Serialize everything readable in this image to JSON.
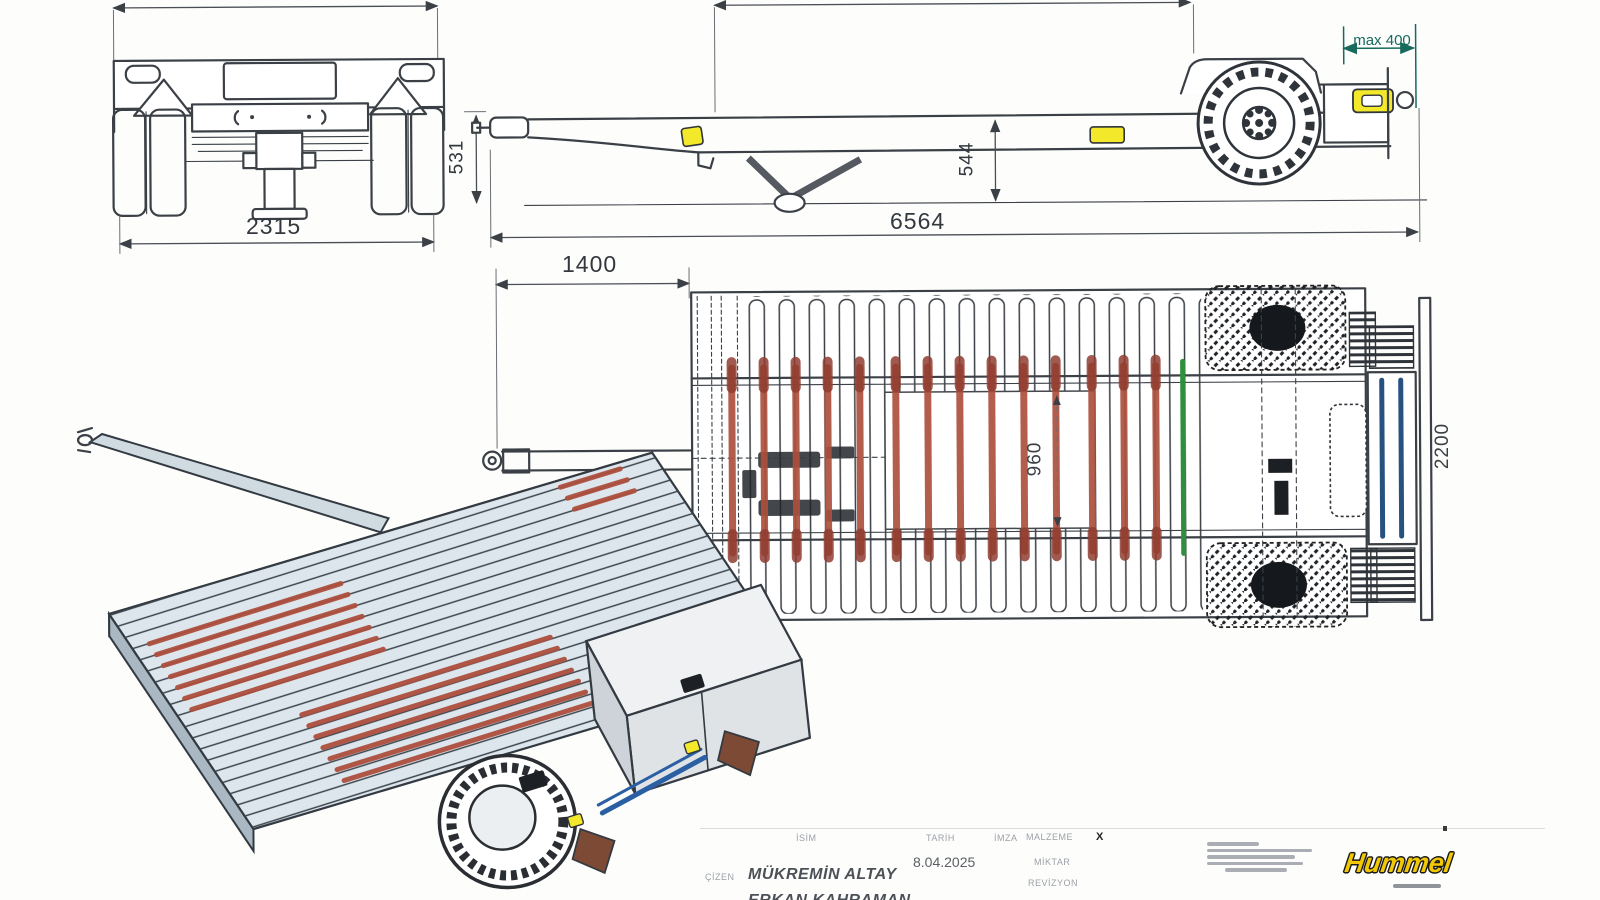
{
  "dimensions": {
    "rear_width": "2315",
    "hitch_height": "531",
    "platform_height": "544",
    "overall_length": "6564",
    "drawbar_length": "1400",
    "inner_width": "960",
    "platform_width": "2200",
    "rear_overhang": "max 400"
  },
  "title_block": {
    "cizen_label": "ÇİZEN",
    "isim_label": "İSİM",
    "tarih_label": "TARİH",
    "imza_label": "İMZA",
    "malzeme_label": "MALZEME",
    "miktar_label": "MİKTAR",
    "revizyon_label": "REVİZYON",
    "drawn_by": "MÜKREMİN ALTAY",
    "drawn_by_2": "ERKAN KAHRAMAN",
    "date": "8.04.2025",
    "malzeme_value": "X"
  },
  "branding": {
    "logo_text": "Hummel"
  },
  "colors": {
    "strap_red": "#ad4f3e",
    "strap_green": "#2e8f3c",
    "strap_blue": "#27527f",
    "dim_teal": "#176a5c",
    "marker_yellow": "#f3e92a",
    "logo_yellow": "#f2c703"
  }
}
